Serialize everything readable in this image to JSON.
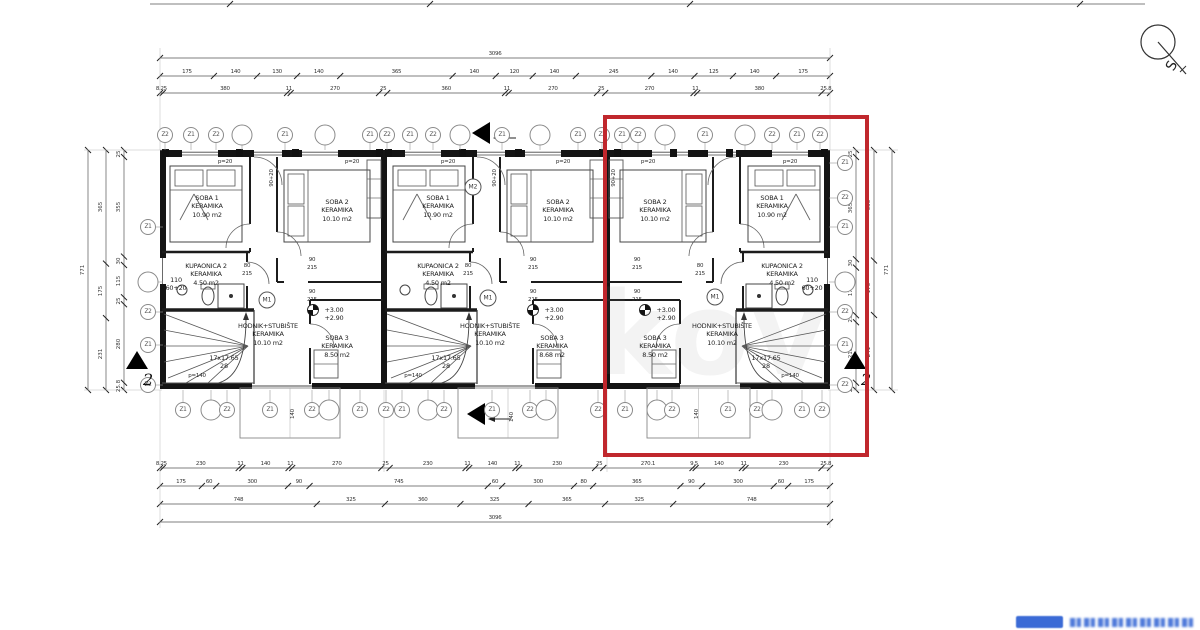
{
  "compass": {
    "label": "S"
  },
  "watermark": {
    "text": "kov"
  },
  "highlight": {
    "x": 603,
    "y": 115,
    "w": 258,
    "h": 334,
    "color": "#c0272d"
  },
  "building": {
    "x": 162,
    "y": 150,
    "w": 666,
    "h": 238,
    "unit_w": 221,
    "units": [
      {
        "name": "unit-1",
        "x": 162,
        "mirrored": false
      },
      {
        "name": "unit-2",
        "x": 385,
        "mirrored": false
      },
      {
        "name": "unit-3",
        "x": 607,
        "mirrored": true
      }
    ],
    "terraces": [
      [
        240,
        100
      ],
      [
        458,
        100
      ],
      [
        647,
        103
      ]
    ]
  },
  "room_labels": [
    {
      "x": 207,
      "y": 194,
      "lines": [
        "SOBA 1",
        "KERAMIKA",
        "10.90 m2"
      ]
    },
    {
      "x": 337,
      "y": 198,
      "lines": [
        "SOBA 2",
        "KERAMIKA",
        "10.10 m2"
      ]
    },
    {
      "x": 206,
      "y": 262,
      "lines": [
        "KUPAONICA 2",
        "KERAMIKA",
        "4.50 m2"
      ]
    },
    {
      "x": 176,
      "y": 276,
      "lines": [
        "110",
        "60+20"
      ]
    },
    {
      "x": 268,
      "y": 322,
      "lines": [
        "HODNIK+STUBIŠTE",
        "KERAMIKA",
        "10.10 m2"
      ]
    },
    {
      "x": 337,
      "y": 334,
      "lines": [
        "SOBA 3",
        "KERAMIKA",
        "8.50 m2"
      ]
    },
    {
      "x": 224,
      "y": 354,
      "lines": [
        "17x17.65",
        "28"
      ]
    },
    {
      "x": 334,
      "y": 306,
      "lines": [
        "+3.00",
        "+2.90"
      ]
    },
    {
      "x": 438,
      "y": 194,
      "lines": [
        "SOBA 1",
        "KERAMIKA",
        "10.90 m2"
      ]
    },
    {
      "x": 558,
      "y": 198,
      "lines": [
        "SOBA 2",
        "KERAMIKA",
        "10.10 m2"
      ]
    },
    {
      "x": 438,
      "y": 262,
      "lines": [
        "KUPAONICA 2",
        "KERAMIKA",
        "4.50 m2"
      ]
    },
    {
      "x": 490,
      "y": 322,
      "lines": [
        "HODNIK+STUBIŠTE",
        "KERAMIKA",
        "10.10 m2"
      ]
    },
    {
      "x": 552,
      "y": 334,
      "lines": [
        "SOBA 3",
        "KERAMIKA",
        "8.68 m2"
      ]
    },
    {
      "x": 446,
      "y": 354,
      "lines": [
        "17x17.65",
        "28"
      ]
    },
    {
      "x": 554,
      "y": 306,
      "lines": [
        "+3.00",
        "+2.90"
      ]
    },
    {
      "x": 655,
      "y": 198,
      "lines": [
        "SOBA 2",
        "KERAMIKA",
        "10.10 m2"
      ]
    },
    {
      "x": 772,
      "y": 194,
      "lines": [
        "SOBA 1",
        "KERAMIKA",
        "10.90 m2"
      ]
    },
    {
      "x": 782,
      "y": 262,
      "lines": [
        "KUPAONICA 2",
        "KERAMIKA",
        "4.50 m2"
      ]
    },
    {
      "x": 812,
      "y": 276,
      "lines": [
        "110",
        "60+20"
      ]
    },
    {
      "x": 722,
      "y": 322,
      "lines": [
        "HODNIK+STUBIŠTE",
        "KERAMIKA",
        "10.10 m2"
      ]
    },
    {
      "x": 655,
      "y": 334,
      "lines": [
        "SOBA 3",
        "KERAMIKA",
        "8.50 m2"
      ]
    },
    {
      "x": 766,
      "y": 354,
      "lines": [
        "17x17.65",
        "28"
      ]
    },
    {
      "x": 666,
      "y": 306,
      "lines": [
        "+3.00",
        "+2.90"
      ]
    }
  ],
  "small_texts": [
    {
      "x": 225,
      "y": 162,
      "t": "p=20"
    },
    {
      "x": 352,
      "y": 162,
      "t": "p=20"
    },
    {
      "x": 448,
      "y": 162,
      "t": "p=20"
    },
    {
      "x": 563,
      "y": 162,
      "t": "p=20"
    },
    {
      "x": 648,
      "y": 162,
      "t": "p=20"
    },
    {
      "x": 790,
      "y": 162,
      "t": "p=20"
    },
    {
      "x": 272,
      "y": 178,
      "t": "90+20",
      "rot": true
    },
    {
      "x": 495,
      "y": 178,
      "t": "90+20",
      "rot": true
    },
    {
      "x": 614,
      "y": 178,
      "t": "90+20",
      "rot": true
    },
    {
      "x": 312,
      "y": 260,
      "t": "90"
    },
    {
      "x": 312,
      "y": 268,
      "t": "215"
    },
    {
      "x": 247,
      "y": 266,
      "t": "80"
    },
    {
      "x": 247,
      "y": 274,
      "t": "215"
    },
    {
      "x": 312,
      "y": 292,
      "t": "90"
    },
    {
      "x": 312,
      "y": 300,
      "t": "215"
    },
    {
      "x": 533,
      "y": 260,
      "t": "90"
    },
    {
      "x": 533,
      "y": 268,
      "t": "215"
    },
    {
      "x": 468,
      "y": 266,
      "t": "80"
    },
    {
      "x": 468,
      "y": 274,
      "t": "215"
    },
    {
      "x": 533,
      "y": 292,
      "t": "90"
    },
    {
      "x": 533,
      "y": 300,
      "t": "215"
    },
    {
      "x": 637,
      "y": 260,
      "t": "90"
    },
    {
      "x": 637,
      "y": 268,
      "t": "215"
    },
    {
      "x": 700,
      "y": 266,
      "t": "80"
    },
    {
      "x": 700,
      "y": 274,
      "t": "215"
    },
    {
      "x": 637,
      "y": 292,
      "t": "90"
    },
    {
      "x": 637,
      "y": 300,
      "t": "215"
    },
    {
      "x": 197,
      "y": 376,
      "t": "p=140"
    },
    {
      "x": 413,
      "y": 376,
      "t": "p=140"
    },
    {
      "x": 790,
      "y": 376,
      "t": "p=140"
    },
    {
      "x": 293,
      "y": 414,
      "t": "140",
      "rot": true
    },
    {
      "x": 512,
      "y": 417,
      "t": "140",
      "rot": true
    },
    {
      "x": 697,
      "y": 414,
      "t": "140",
      "rot": true
    }
  ],
  "m_markers": [
    {
      "x": 267,
      "y": 300,
      "t": "M1"
    },
    {
      "x": 488,
      "y": 298,
      "t": "M1"
    },
    {
      "x": 715,
      "y": 297,
      "t": "M1"
    },
    {
      "x": 473,
      "y": 187,
      "t": "M2"
    }
  ],
  "level_symbols": [
    [
      313,
      310
    ],
    [
      533,
      310
    ],
    [
      645,
      310
    ]
  ],
  "grid": {
    "top": {
      "y": 135,
      "items": [
        [
          165,
          "Z2"
        ],
        [
          191,
          "Z1"
        ],
        [
          216,
          "Z2"
        ],
        [
          242,
          ""
        ],
        [
          285,
          "Z1"
        ],
        [
          325,
          ""
        ],
        [
          370,
          "Z1"
        ],
        [
          387,
          "Z2"
        ],
        [
          410,
          "Z1"
        ],
        [
          433,
          "Z2"
        ],
        [
          460,
          ""
        ],
        [
          502,
          "Z1"
        ],
        [
          540,
          ""
        ],
        [
          578,
          "Z1"
        ],
        [
          602,
          "Z2"
        ],
        [
          622,
          "Z1"
        ],
        [
          638,
          "Z2"
        ],
        [
          665,
          ""
        ],
        [
          705,
          "Z1"
        ],
        [
          745,
          ""
        ],
        [
          772,
          "Z2"
        ],
        [
          797,
          "Z1"
        ],
        [
          820,
          "Z2"
        ]
      ]
    },
    "bottom": {
      "y": 410,
      "items": [
        [
          183,
          "Z1"
        ],
        [
          211,
          ""
        ],
        [
          227,
          "Z2"
        ],
        [
          270,
          "Z1"
        ],
        [
          312,
          "Z2"
        ],
        [
          329,
          ""
        ],
        [
          360,
          "Z1"
        ],
        [
          386,
          "Z2"
        ],
        [
          402,
          "Z1"
        ],
        [
          428,
          ""
        ],
        [
          444,
          "Z2"
        ],
        [
          492,
          "Z1"
        ],
        [
          530,
          "Z2"
        ],
        [
          546,
          ""
        ],
        [
          598,
          "Z2"
        ],
        [
          625,
          "Z1"
        ],
        [
          657,
          ""
        ],
        [
          672,
          "Z2"
        ],
        [
          728,
          "Z1"
        ],
        [
          757,
          "Z2"
        ],
        [
          772,
          ""
        ],
        [
          802,
          "Z1"
        ],
        [
          822,
          "Z2"
        ]
      ]
    },
    "left": {
      "x": 148,
      "items": [
        [
          227,
          "Z1"
        ],
        [
          282,
          ""
        ],
        [
          312,
          "Z2"
        ],
        [
          345,
          "Z1"
        ],
        [
          385,
          "Z2"
        ]
      ]
    },
    "right": {
      "x": 845,
      "items": [
        [
          163,
          "Z1"
        ],
        [
          198,
          "Z2"
        ],
        [
          227,
          "Z1"
        ],
        [
          282,
          ""
        ],
        [
          312,
          "Z2"
        ],
        [
          345,
          "Z1"
        ],
        [
          385,
          "Z2"
        ]
      ]
    }
  },
  "dims": {
    "h": [
      {
        "y": 58,
        "x1": 160,
        "x2": 830,
        "vals": [
          "3096"
        ],
        "total": true
      },
      {
        "y": 76,
        "x1": 160,
        "x2": 830,
        "vals": [
          "175",
          "140",
          "130",
          "140",
          "365",
          "140",
          "120",
          "140",
          "245",
          "140",
          "125",
          "140",
          "175"
        ]
      },
      {
        "y": 93,
        "x1": 160,
        "x2": 830,
        "vals": [
          "8.25",
          "380",
          "11",
          "270",
          "25",
          "360",
          "11",
          "270",
          "25",
          "270",
          "11",
          "380",
          "25.8"
        ]
      },
      {
        "y": 468,
        "x1": 160,
        "x2": 830,
        "vals": [
          "8.25",
          "230",
          "11",
          "140",
          "11",
          "270",
          "25",
          "230",
          "11",
          "140",
          "11",
          "230",
          "25",
          "270.1",
          "9.5",
          "140",
          "11",
          "230",
          "25.8"
        ]
      },
      {
        "y": 486,
        "x1": 160,
        "x2": 830,
        "vals": [
          "175",
          "60",
          "300",
          "90",
          "745",
          "60",
          "300",
          "80",
          "365",
          "90",
          "300",
          "60",
          "175"
        ]
      },
      {
        "y": 504,
        "x1": 160,
        "x2": 830,
        "vals": [
          "748",
          "325",
          "360",
          "325",
          "365",
          "325",
          "748"
        ]
      },
      {
        "y": 522,
        "x1": 160,
        "x2": 830,
        "vals": [
          "3096"
        ],
        "total": true
      }
    ],
    "v": [
      {
        "x": 88,
        "y1": 150,
        "y2": 390,
        "vals": [
          "771"
        ],
        "total": true
      },
      {
        "x": 106,
        "y1": 150,
        "y2": 390,
        "vals": [
          "365",
          "175",
          "231"
        ]
      },
      {
        "x": 124,
        "y1": 150,
        "y2": 390,
        "vals": [
          "25",
          "355",
          "30",
          "115",
          "25",
          "280",
          "25.8"
        ]
      },
      {
        "x": 856,
        "y1": 150,
        "y2": 390,
        "vals": [
          "25",
          "365",
          "30",
          "170",
          "25",
          "216",
          "25.8"
        ]
      },
      {
        "x": 874,
        "y1": 150,
        "y2": 390,
        "vals": [
          "355",
          "175",
          "241"
        ]
      },
      {
        "x": 892,
        "y1": 150,
        "y2": 390,
        "vals": [
          "771"
        ],
        "total": true
      }
    ],
    "cut_ticks": {
      "y": 4,
      "x1": 150,
      "x2": 1145,
      "ticks": [
        230,
        430,
        690,
        1080
      ]
    }
  },
  "section_markers": {
    "tri_left": [
      {
        "x": 480,
        "y": 133
      },
      {
        "x": 475,
        "y": 414
      }
    ],
    "tri_up": [
      {
        "x": 137,
        "y": 360,
        "label": "2"
      },
      {
        "x": 855,
        "y": 360,
        "label": "2"
      }
    ]
  }
}
